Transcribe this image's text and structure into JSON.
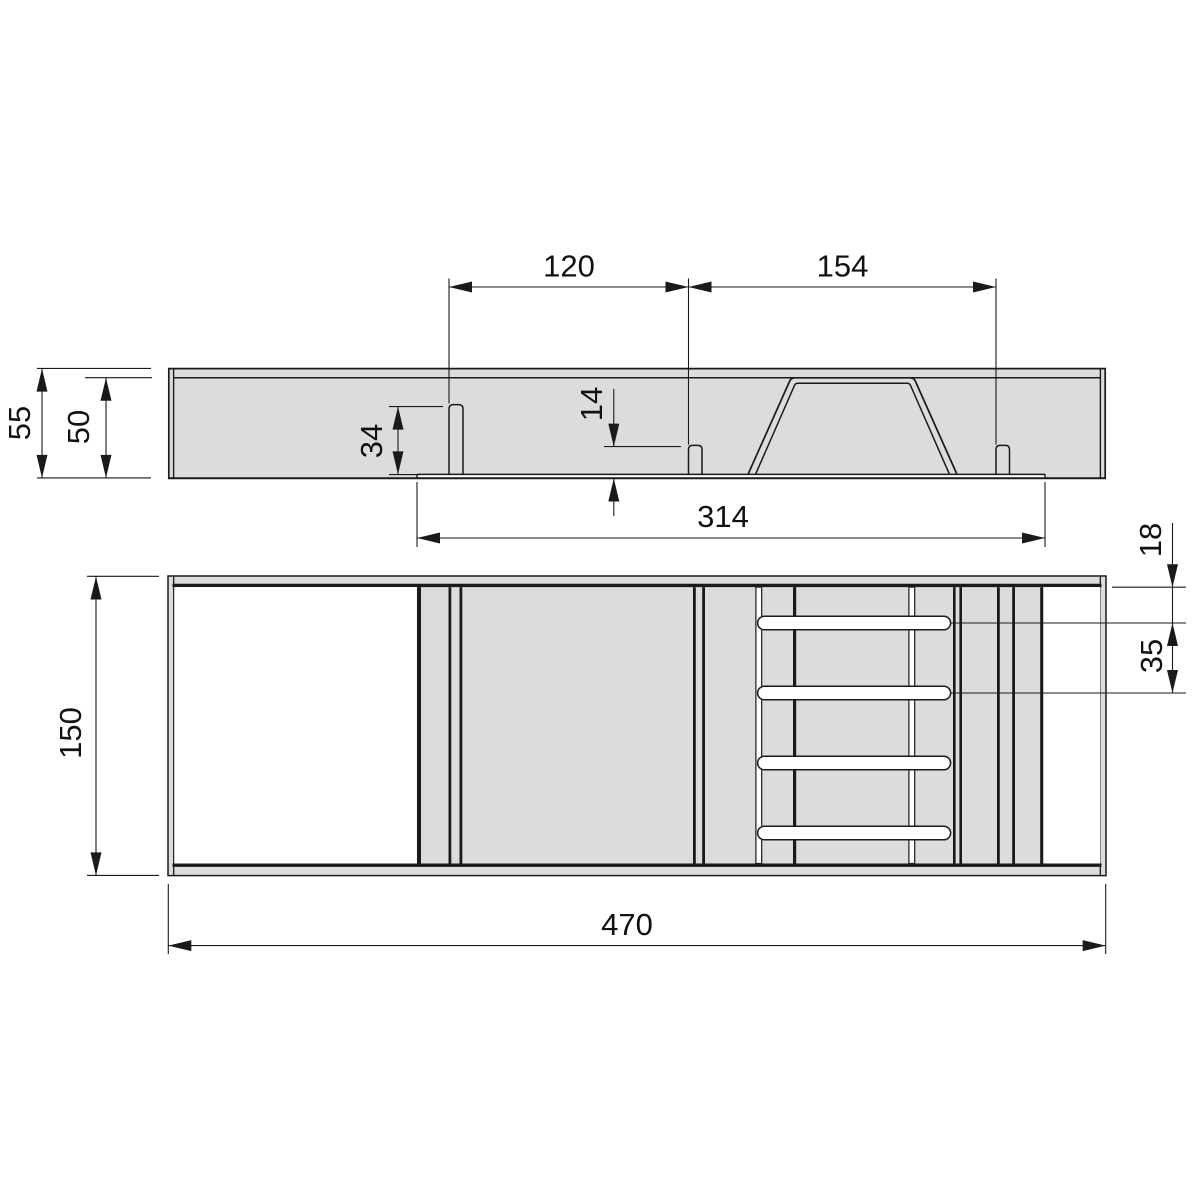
{
  "drawing": {
    "kind": "dimensioned technical drawing, two orthographic views",
    "side_view": {
      "dim_left_pin_offset": "120",
      "dim_right_pin_offset": "154",
      "dim_overall_height": "55",
      "dim_inner_height": "50",
      "dim_tall_pin_height": "34",
      "dim_short_pin_height": "14",
      "dim_recess_width": "314"
    },
    "plan_view": {
      "dim_depth": "150",
      "dim_overall_width": "470",
      "dim_first_slot_offset": "18",
      "dim_slot_spacing": "35"
    },
    "colors": {
      "panel_fill": "#dcdcdc",
      "outline": "#1a1a1a",
      "background": "#ffffff"
    }
  }
}
